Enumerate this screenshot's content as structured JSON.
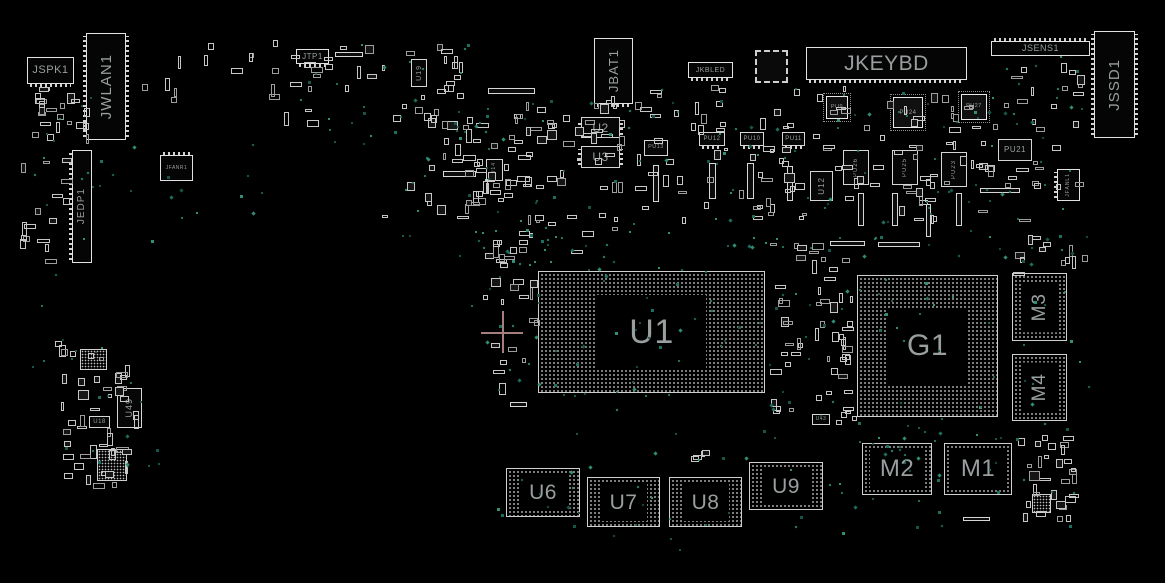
{
  "board": {
    "background": "#000000",
    "outline_color": "#d6d6d6",
    "label_color": "#999f9f",
    "via_colors": [
      "#1d6e5e",
      "#2f8d78",
      "#17544a"
    ],
    "crosshair_color": "#a57e7e"
  },
  "crosshair": {
    "x": 502,
    "y": 332,
    "arm": 21
  },
  "components": [
    {
      "id": "jspk1",
      "label": "JSPK1",
      "type": "conn",
      "orient": "h",
      "x": 27,
      "y": 57,
      "w": 47,
      "h": 27,
      "fs": 11,
      "pins": "bottom"
    },
    {
      "id": "jwlan1",
      "label": "JWLAN1",
      "type": "conn",
      "orient": "v",
      "x": 86,
      "y": 33,
      "w": 40,
      "h": 107,
      "fs": 15,
      "pins": "lr"
    },
    {
      "id": "jedp1",
      "label": "JEDP1",
      "type": "conn",
      "orient": "v",
      "x": 72,
      "y": 150,
      "w": 20,
      "h": 113,
      "fs": 10,
      "pins": "left"
    },
    {
      "id": "jfanr1",
      "label": "JFANR1",
      "type": "conn",
      "orient": "h",
      "x": 160,
      "y": 155,
      "w": 33,
      "h": 26,
      "fs": 5,
      "pins": "top"
    },
    {
      "id": "jtp1",
      "label": "JTP1",
      "type": "conn",
      "orient": "h",
      "x": 296,
      "y": 49,
      "w": 33,
      "h": 15,
      "fs": 8,
      "pins": "bottom"
    },
    {
      "id": "jbat1",
      "label": "JBAT1",
      "type": "conn",
      "orient": "v",
      "x": 594,
      "y": 38,
      "w": 39,
      "h": 66,
      "fs": 13,
      "pins": "bottom"
    },
    {
      "id": "jkbled",
      "label": "JKBLED",
      "type": "conn",
      "orient": "h",
      "x": 688,
      "y": 62,
      "w": 45,
      "h": 16,
      "fs": 7,
      "pins": "bottom"
    },
    {
      "id": "jkeybd",
      "label": "JKEYBD",
      "type": "conn",
      "orient": "h",
      "x": 806,
      "y": 47,
      "w": 161,
      "h": 33,
      "fs": 21,
      "pins": "bottom"
    },
    {
      "id": "jsens1",
      "label": "JSENS1",
      "type": "conn",
      "orient": "h",
      "x": 991,
      "y": 41,
      "w": 99,
      "h": 15,
      "fs": 9,
      "pins": "top"
    },
    {
      "id": "jssd1",
      "label": "JSSD1",
      "type": "conn",
      "orient": "v",
      "x": 1094,
      "y": 31,
      "w": 41,
      "h": 107,
      "fs": 15,
      "pins": "lr"
    },
    {
      "id": "jfanl1",
      "label": "JFANL1",
      "type": "conn",
      "orient": "v",
      "x": 1057,
      "y": 169,
      "w": 23,
      "h": 32,
      "fs": 5,
      "pins": "left"
    },
    {
      "id": "u19",
      "label": "U19",
      "type": "ic",
      "orient": "v",
      "x": 411,
      "y": 59,
      "w": 16,
      "h": 28,
      "fs": 7
    },
    {
      "id": "u2",
      "label": "U2",
      "type": "ic",
      "orient": "h",
      "x": 581,
      "y": 117,
      "w": 39,
      "h": 21,
      "fs": 12,
      "pins": "lr"
    },
    {
      "id": "u3",
      "label": "U3",
      "type": "ic",
      "orient": "h",
      "x": 581,
      "y": 146,
      "w": 39,
      "h": 22,
      "fs": 12,
      "pins": "lr"
    },
    {
      "id": "pu13",
      "label": "PU13",
      "type": "ic",
      "orient": "h",
      "x": 644,
      "y": 140,
      "w": 24,
      "h": 16,
      "fs": 5.5
    },
    {
      "id": "pu14",
      "label": "PU14",
      "type": "ic",
      "orient": "v",
      "x": 486,
      "y": 159,
      "w": 17,
      "h": 22,
      "fs": 5
    },
    {
      "id": "pu12",
      "label": "PU12",
      "type": "ic",
      "orient": "h",
      "x": 699,
      "y": 132,
      "w": 26,
      "h": 14,
      "fs": 6,
      "pins": "bottom"
    },
    {
      "id": "pu10",
      "label": "PU10",
      "type": "ic",
      "orient": "h",
      "x": 740,
      "y": 132,
      "w": 24,
      "h": 14,
      "fs": 6,
      "pins": "bottom"
    },
    {
      "id": "pu11",
      "label": "PU11",
      "type": "ic",
      "orient": "h",
      "x": 782,
      "y": 132,
      "w": 23,
      "h": 14,
      "fs": 6,
      "pins": "bottom"
    },
    {
      "id": "pu9",
      "label": "PU9",
      "type": "qfn",
      "orient": "h",
      "x": 826,
      "y": 96,
      "w": 22,
      "h": 23,
      "fs": 5.5
    },
    {
      "id": "pu24",
      "label": "PU24",
      "type": "qfn",
      "orient": "h",
      "x": 893,
      "y": 97,
      "w": 30,
      "h": 31,
      "fs": 6
    },
    {
      "id": "pu27",
      "label": "PU27",
      "type": "qfn",
      "orient": "h",
      "x": 961,
      "y": 94,
      "w": 26,
      "h": 26,
      "fs": 5.5
    },
    {
      "id": "pu21",
      "label": "PU21",
      "type": "ic",
      "orient": "h",
      "x": 998,
      "y": 139,
      "w": 34,
      "h": 22,
      "fs": 8
    },
    {
      "id": "pu26",
      "label": "PU26",
      "type": "ic",
      "orient": "v",
      "x": 843,
      "y": 150,
      "w": 26,
      "h": 35,
      "fs": 6
    },
    {
      "id": "pu25",
      "label": "PU25",
      "type": "ic",
      "orient": "v",
      "x": 892,
      "y": 150,
      "w": 26,
      "h": 35,
      "fs": 6
    },
    {
      "id": "pu23",
      "label": "PU23",
      "type": "ic",
      "orient": "v",
      "x": 941,
      "y": 152,
      "w": 26,
      "h": 35,
      "fs": 6
    },
    {
      "id": "u12",
      "label": "U12",
      "type": "ic",
      "orient": "v",
      "x": 810,
      "y": 171,
      "w": 23,
      "h": 30,
      "fs": 8
    },
    {
      "id": "u49",
      "label": "U49",
      "type": "ic",
      "orient": "v",
      "x": 117,
      "y": 388,
      "w": 25,
      "h": 40,
      "fs": 9
    },
    {
      "id": "u18",
      "label": "U18",
      "type": "ic",
      "orient": "h",
      "x": 89,
      "y": 416,
      "w": 21,
      "h": 12,
      "fs": 6
    },
    {
      "id": "u43",
      "label": "U43",
      "type": "ic",
      "orient": "h",
      "x": 812,
      "y": 414,
      "w": 18,
      "h": 11,
      "fs": 5
    },
    {
      "id": "qfp-unlabeled",
      "label": "",
      "type": "qfp",
      "orient": "h",
      "x": 755,
      "y": 50,
      "w": 33,
      "h": 33,
      "fs": 6
    },
    {
      "id": "bga-small-1",
      "label": "",
      "type": "sbga",
      "orient": "h",
      "x": 80,
      "y": 349,
      "w": 27,
      "h": 21,
      "fs": 5
    },
    {
      "id": "bga-small-2",
      "label": "",
      "type": "sbga",
      "orient": "h",
      "x": 97,
      "y": 449,
      "w": 30,
      "h": 32,
      "fs": 5
    },
    {
      "id": "bga-small-3",
      "label": "",
      "type": "sbga",
      "orient": "h",
      "x": 1032,
      "y": 494,
      "w": 19,
      "h": 19,
      "fs": 5
    },
    {
      "id": "u1",
      "label": "U1",
      "type": "bga",
      "orient": "h",
      "x": 538,
      "y": 271,
      "w": 227,
      "h": 122,
      "fs": 34
    },
    {
      "id": "g1",
      "label": "G1",
      "type": "bga",
      "orient": "h",
      "x": 857,
      "y": 275,
      "w": 141,
      "h": 142,
      "fs": 30
    },
    {
      "id": "m3",
      "label": "M3",
      "type": "bga",
      "orient": "v",
      "x": 1012,
      "y": 273,
      "w": 55,
      "h": 68,
      "fs": 19
    },
    {
      "id": "m4",
      "label": "M4",
      "type": "bga",
      "orient": "v",
      "x": 1012,
      "y": 354,
      "w": 55,
      "h": 67,
      "fs": 19
    },
    {
      "id": "m2",
      "label": "M2",
      "type": "bga",
      "orient": "h",
      "x": 862,
      "y": 443,
      "w": 70,
      "h": 52,
      "fs": 24
    },
    {
      "id": "m1",
      "label": "M1",
      "type": "bga",
      "orient": "h",
      "x": 944,
      "y": 443,
      "w": 68,
      "h": 52,
      "fs": 24
    },
    {
      "id": "u6",
      "label": "U6",
      "type": "bga",
      "orient": "h",
      "x": 506,
      "y": 468,
      "w": 74,
      "h": 49,
      "fs": 21
    },
    {
      "id": "u7",
      "label": "U7",
      "type": "bga",
      "orient": "h",
      "x": 587,
      "y": 477,
      "w": 73,
      "h": 50,
      "fs": 21
    },
    {
      "id": "u8",
      "label": "U8",
      "type": "bga",
      "orient": "h",
      "x": 669,
      "y": 477,
      "w": 73,
      "h": 50,
      "fs": 21
    },
    {
      "id": "u9",
      "label": "U9",
      "type": "bga",
      "orient": "h",
      "x": 749,
      "y": 462,
      "w": 74,
      "h": 48,
      "fs": 21
    }
  ],
  "bars": [
    {
      "x": 488,
      "y": 88,
      "w": 47,
      "h": 6
    },
    {
      "x": 335,
      "y": 52,
      "w": 28,
      "h": 5
    },
    {
      "x": 443,
      "y": 171,
      "w": 33,
      "h": 6
    },
    {
      "x": 653,
      "y": 165,
      "w": 6,
      "h": 37
    },
    {
      "x": 709,
      "y": 163,
      "w": 7,
      "h": 36
    },
    {
      "x": 747,
      "y": 163,
      "w": 7,
      "h": 36
    },
    {
      "x": 787,
      "y": 166,
      "w": 6,
      "h": 35
    },
    {
      "x": 858,
      "y": 193,
      "w": 6,
      "h": 33
    },
    {
      "x": 892,
      "y": 193,
      "w": 6,
      "h": 33
    },
    {
      "x": 926,
      "y": 204,
      "w": 5,
      "h": 33
    },
    {
      "x": 956,
      "y": 193,
      "w": 6,
      "h": 33
    },
    {
      "x": 980,
      "y": 188,
      "w": 40,
      "h": 5
    },
    {
      "x": 830,
      "y": 241,
      "w": 35,
      "h": 5
    },
    {
      "x": 878,
      "y": 242,
      "w": 42,
      "h": 5
    },
    {
      "x": 510,
      "y": 402,
      "w": 17,
      "h": 5
    },
    {
      "x": 963,
      "y": 517,
      "w": 27,
      "h": 4
    }
  ],
  "part_clusters": [
    {
      "x": 30,
      "y": 85,
      "w": 60,
      "h": 60,
      "n": 22,
      "seed": 1
    },
    {
      "x": 18,
      "y": 150,
      "w": 55,
      "h": 115,
      "n": 16,
      "seed": 2
    },
    {
      "x": 55,
      "y": 340,
      "w": 85,
      "h": 90,
      "n": 26,
      "seed": 3
    },
    {
      "x": 58,
      "y": 428,
      "w": 75,
      "h": 62,
      "n": 20,
      "seed": 4
    },
    {
      "x": 140,
      "y": 38,
      "w": 115,
      "h": 65,
      "n": 10,
      "seed": 5
    },
    {
      "x": 268,
      "y": 38,
      "w": 200,
      "h": 95,
      "n": 40,
      "seed": 6
    },
    {
      "x": 378,
      "y": 105,
      "w": 185,
      "h": 120,
      "n": 46,
      "seed": 7
    },
    {
      "x": 455,
      "y": 150,
      "w": 170,
      "h": 115,
      "n": 40,
      "seed": 8
    },
    {
      "x": 516,
      "y": 92,
      "w": 115,
      "h": 62,
      "n": 22,
      "seed": 9
    },
    {
      "x": 632,
      "y": 82,
      "w": 175,
      "h": 145,
      "n": 55,
      "seed": 10
    },
    {
      "x": 812,
      "y": 84,
      "w": 190,
      "h": 142,
      "n": 60,
      "seed": 11
    },
    {
      "x": 1000,
      "y": 58,
      "w": 88,
      "h": 170,
      "n": 26,
      "seed": 12
    },
    {
      "x": 766,
      "y": 236,
      "w": 92,
      "h": 190,
      "n": 48,
      "seed": 13
    },
    {
      "x": 482,
      "y": 232,
      "w": 58,
      "h": 165,
      "n": 20,
      "seed": 14
    },
    {
      "x": 1012,
      "y": 232,
      "w": 78,
      "h": 48,
      "n": 12,
      "seed": 15
    },
    {
      "x": 1013,
      "y": 427,
      "w": 68,
      "h": 98,
      "n": 30,
      "seed": 16
    },
    {
      "x": 836,
      "y": 282,
      "w": 20,
      "h": 140,
      "n": 8,
      "seed": 17
    },
    {
      "x": 690,
      "y": 448,
      "w": 24,
      "h": 14,
      "n": 4,
      "seed": 18
    }
  ],
  "via_clusters": [
    {
      "x": 380,
      "y": 95,
      "w": 250,
      "h": 185,
      "n": 55,
      "seed": 21
    },
    {
      "x": 470,
      "y": 225,
      "w": 340,
      "h": 185,
      "n": 80,
      "seed": 22
    },
    {
      "x": 625,
      "y": 78,
      "w": 385,
      "h": 160,
      "n": 70,
      "seed": 23
    },
    {
      "x": 28,
      "y": 78,
      "w": 130,
      "h": 290,
      "n": 25,
      "seed": 24
    },
    {
      "x": 800,
      "y": 228,
      "w": 300,
      "h": 215,
      "n": 60,
      "seed": 25
    },
    {
      "x": 485,
      "y": 425,
      "w": 360,
      "h": 125,
      "n": 35,
      "seed": 26
    },
    {
      "x": 838,
      "y": 415,
      "w": 255,
      "h": 115,
      "n": 35,
      "seed": 27
    },
    {
      "x": 282,
      "y": 38,
      "w": 190,
      "h": 105,
      "n": 22,
      "seed": 28
    },
    {
      "x": 998,
      "y": 55,
      "w": 95,
      "h": 185,
      "n": 20,
      "seed": 29
    },
    {
      "x": 140,
      "y": 138,
      "w": 130,
      "h": 85,
      "n": 10,
      "seed": 30
    },
    {
      "x": 60,
      "y": 340,
      "w": 100,
      "h": 150,
      "n": 15,
      "seed": 31
    }
  ]
}
